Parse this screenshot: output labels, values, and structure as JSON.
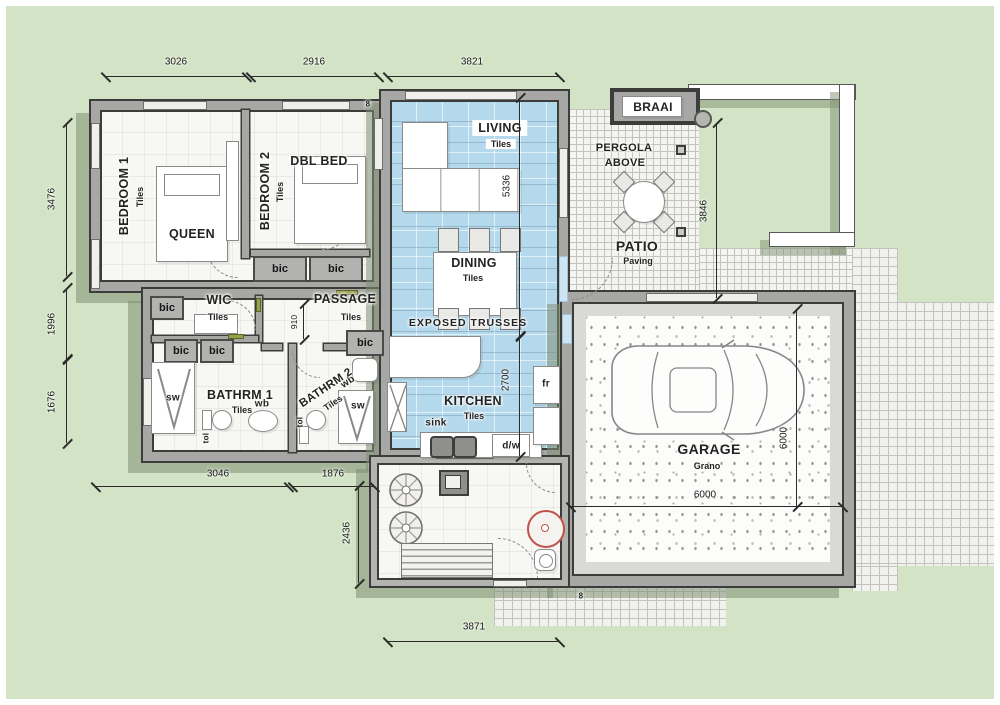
{
  "rooms": {
    "bedroom1": {
      "name": "BEDROOM 1",
      "finish": "Tiles",
      "furniture": "QUEEN"
    },
    "bedroom2": {
      "name": "BEDROOM 2",
      "finish": "Tiles",
      "furniture": "DBL BED"
    },
    "living": {
      "name": "LIVING",
      "finish": "Tiles"
    },
    "dining": {
      "name": "DINING",
      "finish": "Tiles"
    },
    "kitchen": {
      "name": "KITCHEN",
      "finish": "Tiles"
    },
    "wic": {
      "name": "WIC",
      "finish": "Tiles"
    },
    "passage": {
      "name": "PASSAGE",
      "finish": "Tiles"
    },
    "bathroom1": {
      "name": "BATHRM 1",
      "finish": "Tiles"
    },
    "bathroom2": {
      "name": "BATHRM 2",
      "finish": "Tiles"
    },
    "garage": {
      "name": "GARAGE",
      "finish": "Grano"
    },
    "patio": {
      "name": "PATIO",
      "finish": "Paving"
    },
    "braai": {
      "name": "BRAAI"
    },
    "pergola": {
      "line1": "PERGOLA",
      "line2": "ABOVE"
    }
  },
  "annotations": {
    "exposed_trusses": "EXPOSED TRUSSES",
    "door_tag": "8"
  },
  "fixtures": {
    "bic": "bic",
    "sw": "sw",
    "wb": "wb",
    "tol": "tol",
    "sink": "sink",
    "dw": "d/w",
    "fr": "fr"
  },
  "dimensions": {
    "top": [
      "3026",
      "2916",
      "3821"
    ],
    "left": [
      "3476",
      "1996",
      "1676"
    ],
    "patio_depth": "3846",
    "living_length": "5336",
    "kitchen_length": "2700",
    "passage_width": "910",
    "bottom_left": [
      "3046",
      "1876"
    ],
    "yard_depth": "2436",
    "bottom": "3871",
    "garage_width": "6000",
    "garage_depth": "6000"
  },
  "colors": {
    "background": "#d2e4c5",
    "tiled_zone": "#b4d8ec",
    "wall": "#a7a7a5",
    "accent_red": "#c0524a"
  }
}
